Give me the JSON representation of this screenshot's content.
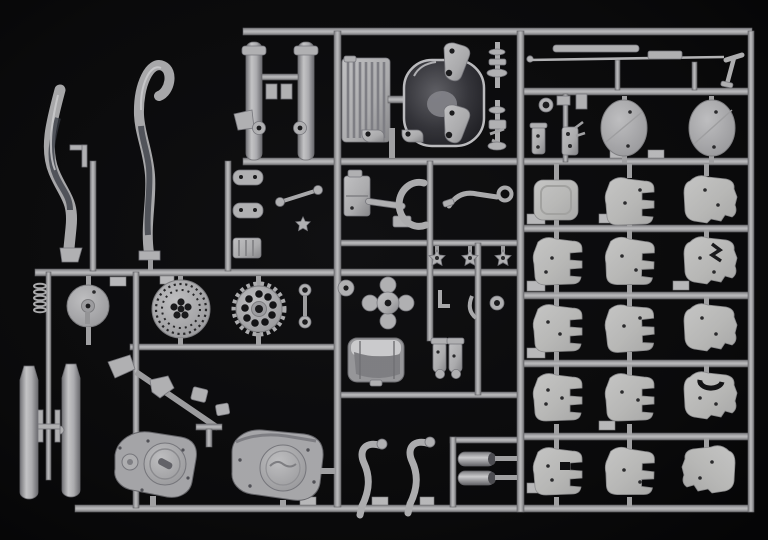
{
  "scene": {
    "type": "photograph",
    "subject": "Plastic scale-model kit sprue of light grey motorcycle parts photographed on a black background",
    "palette": {
      "background": "#09090a",
      "runner": "#b6b6b8",
      "part_light": "#dcdcde",
      "part_mid": "#c4c4c6",
      "part_shadow": "#8f8f92",
      "plate": "#d6d6d4",
      "dark_metal": "#35353a",
      "hole": "#1d1d1f"
    },
    "parts_visible": [
      {
        "id": "exhaust-pipe-left",
        "label": "exhaust header pipe, S-curved"
      },
      {
        "id": "exhaust-pipe-right",
        "label": "exhaust header pipe with hooked top"
      },
      {
        "id": "fork-lower-legs",
        "label": "front fork lower legs, pair"
      },
      {
        "id": "radiator",
        "label": "ribbed radiator / oil cooler core"
      },
      {
        "id": "airbox",
        "label": "dark oval airbox / lamp housing"
      },
      {
        "id": "suspension-brackets",
        "label": "suspension link brackets, pair"
      },
      {
        "id": "steering-stem",
        "label": "steering stem and shock shaft parts"
      },
      {
        "id": "axle-rod",
        "label": "long thin axle rod with lever"
      },
      {
        "id": "side-covers",
        "label": "large oval side covers, pair"
      },
      {
        "id": "wheel-hub",
        "label": "drum wheel hub"
      },
      {
        "id": "brake-disc",
        "label": "drilled brake disc"
      },
      {
        "id": "rear-sprocket",
        "label": "rear drive sprocket"
      },
      {
        "id": "coil-spring",
        "label": "small coil spring"
      },
      {
        "id": "fuel-tank",
        "label": "fuel tank with chrome highlight"
      },
      {
        "id": "carburettors",
        "label": "carburettor pair"
      },
      {
        "id": "engine-case-left",
        "label": "engine crankcase half, left"
      },
      {
        "id": "engine-case-right",
        "label": "engine crankcase half with logo cover"
      },
      {
        "id": "fork-sliders",
        "label": "fork slider tubes, pair"
      },
      {
        "id": "fender-braces",
        "label": "curved fender braces, pair"
      },
      {
        "id": "silencer-tips",
        "label": "silencer end cans, pair"
      },
      {
        "id": "flat-plates",
        "label": "grid of flat moulded plates, five rows by three columns"
      },
      {
        "id": "star-knobs",
        "label": "three small star-shaped knobs"
      },
      {
        "id": "kick-lever",
        "label": "kick-start lever"
      },
      {
        "id": "small-links",
        "label": "assorted small links, brackets and fittings"
      }
    ]
  }
}
